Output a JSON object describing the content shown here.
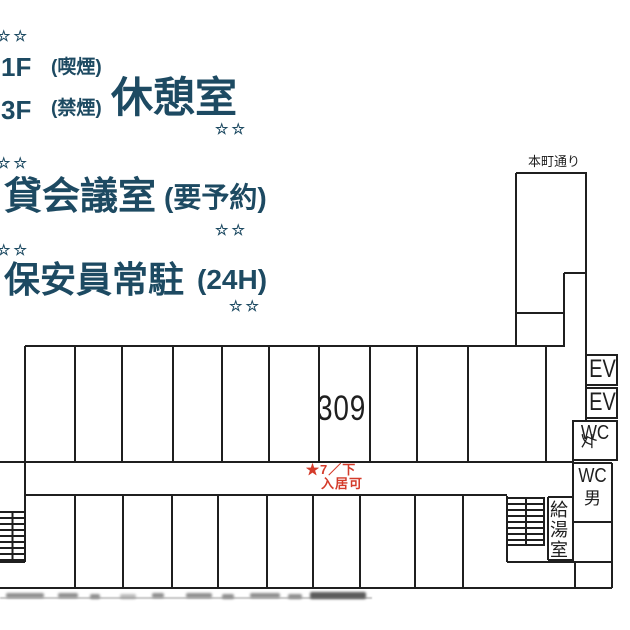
{
  "colors": {
    "background": "#ffffff",
    "promo_text_navy": "#1d4a62",
    "availability_red": "#d43b2a",
    "plan_line_ink": "#1f1f1f"
  },
  "promo": {
    "stars": "☆☆",
    "floor1": "1F",
    "floor1_note": "(喫煙)",
    "floor3": "3F",
    "floor3_note": "(禁煙)",
    "rest_room": "休憩室",
    "meeting_room": "貸会議室",
    "meeting_room_note": "(要予約)",
    "security": "保安員常駐",
    "security_note": "(24H)"
  },
  "plan": {
    "street": "本町通り",
    "room_number": "309",
    "availability_line1": "★7／下",
    "availability_line2": "入居可",
    "elevator": "EV",
    "wc": "WC",
    "female": "女",
    "male": "男",
    "kitchenette": "給湯室"
  }
}
